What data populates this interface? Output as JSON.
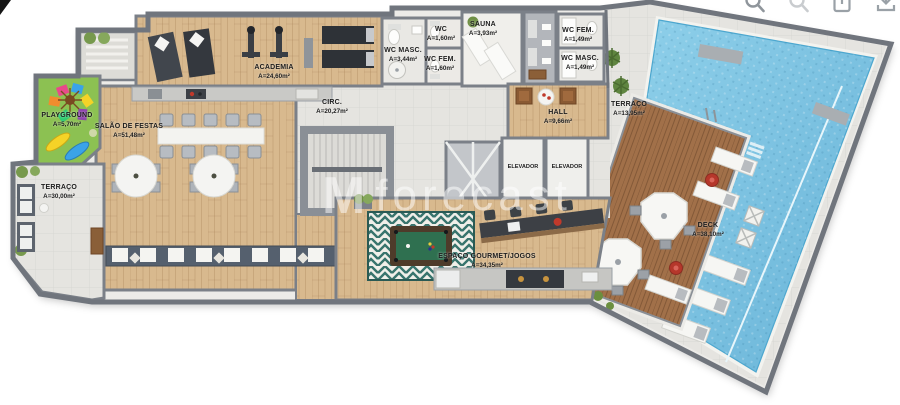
{
  "watermark": {
    "logo": "M",
    "text": "forecast"
  },
  "toolbar": {
    "icons": [
      {
        "name": "zoom-in"
      },
      {
        "name": "zoom-out"
      },
      {
        "name": "export"
      },
      {
        "name": "download"
      }
    ]
  },
  "rooms": {
    "playground": {
      "label": "PLAYGROUND",
      "area": "A=5,70m²"
    },
    "terraco_oeste": {
      "label": "TERRAÇO",
      "area": "A=30,00m²"
    },
    "salao": {
      "label": "SALÃO DE FESTAS",
      "area": "A=51,48m²"
    },
    "academia": {
      "label": "ACADEMIA",
      "area": "A=24,60m²"
    },
    "wc_masc": {
      "label": "WC MASC.",
      "area": "A=3,44m²"
    },
    "wc": {
      "label": "WC",
      "area": "A=1,60m²"
    },
    "wc_fem": {
      "label": "WC FEM.",
      "area": "A=1,60m²"
    },
    "sauna": {
      "label": "SAUNA",
      "area": "A=3,93m²"
    },
    "wc_fem_2": {
      "label": "WC FEM.",
      "area": "A=1,49m²"
    },
    "wc_masc_2": {
      "label": "WC MASC.",
      "area": "A=1,49m²"
    },
    "circ": {
      "label": "CIRC.",
      "area": "A=20,27m²"
    },
    "hall": {
      "label": "HALL",
      "area": "A=9,66m²"
    },
    "elevador_1": {
      "label": "ELEVADOR"
    },
    "elevador_2": {
      "label": "ELEVADOR"
    },
    "terraco_leste": {
      "label": "TERRAÇO",
      "area": "A=13,95m²"
    },
    "gourmet": {
      "label": "ESPAÇO GOURMET/JOGOS",
      "area": "A=34,35m²"
    },
    "deck": {
      "label": "DECK",
      "area": "A=38,10m²"
    }
  },
  "palette": {
    "wall": "#7b8088",
    "wood": "#d8b98e",
    "deck_wood": "#a17049",
    "water": "#7cc3e2",
    "tile": "#e5e4e0",
    "grass": "#8cc152",
    "accent_red": "#b5372b"
  }
}
